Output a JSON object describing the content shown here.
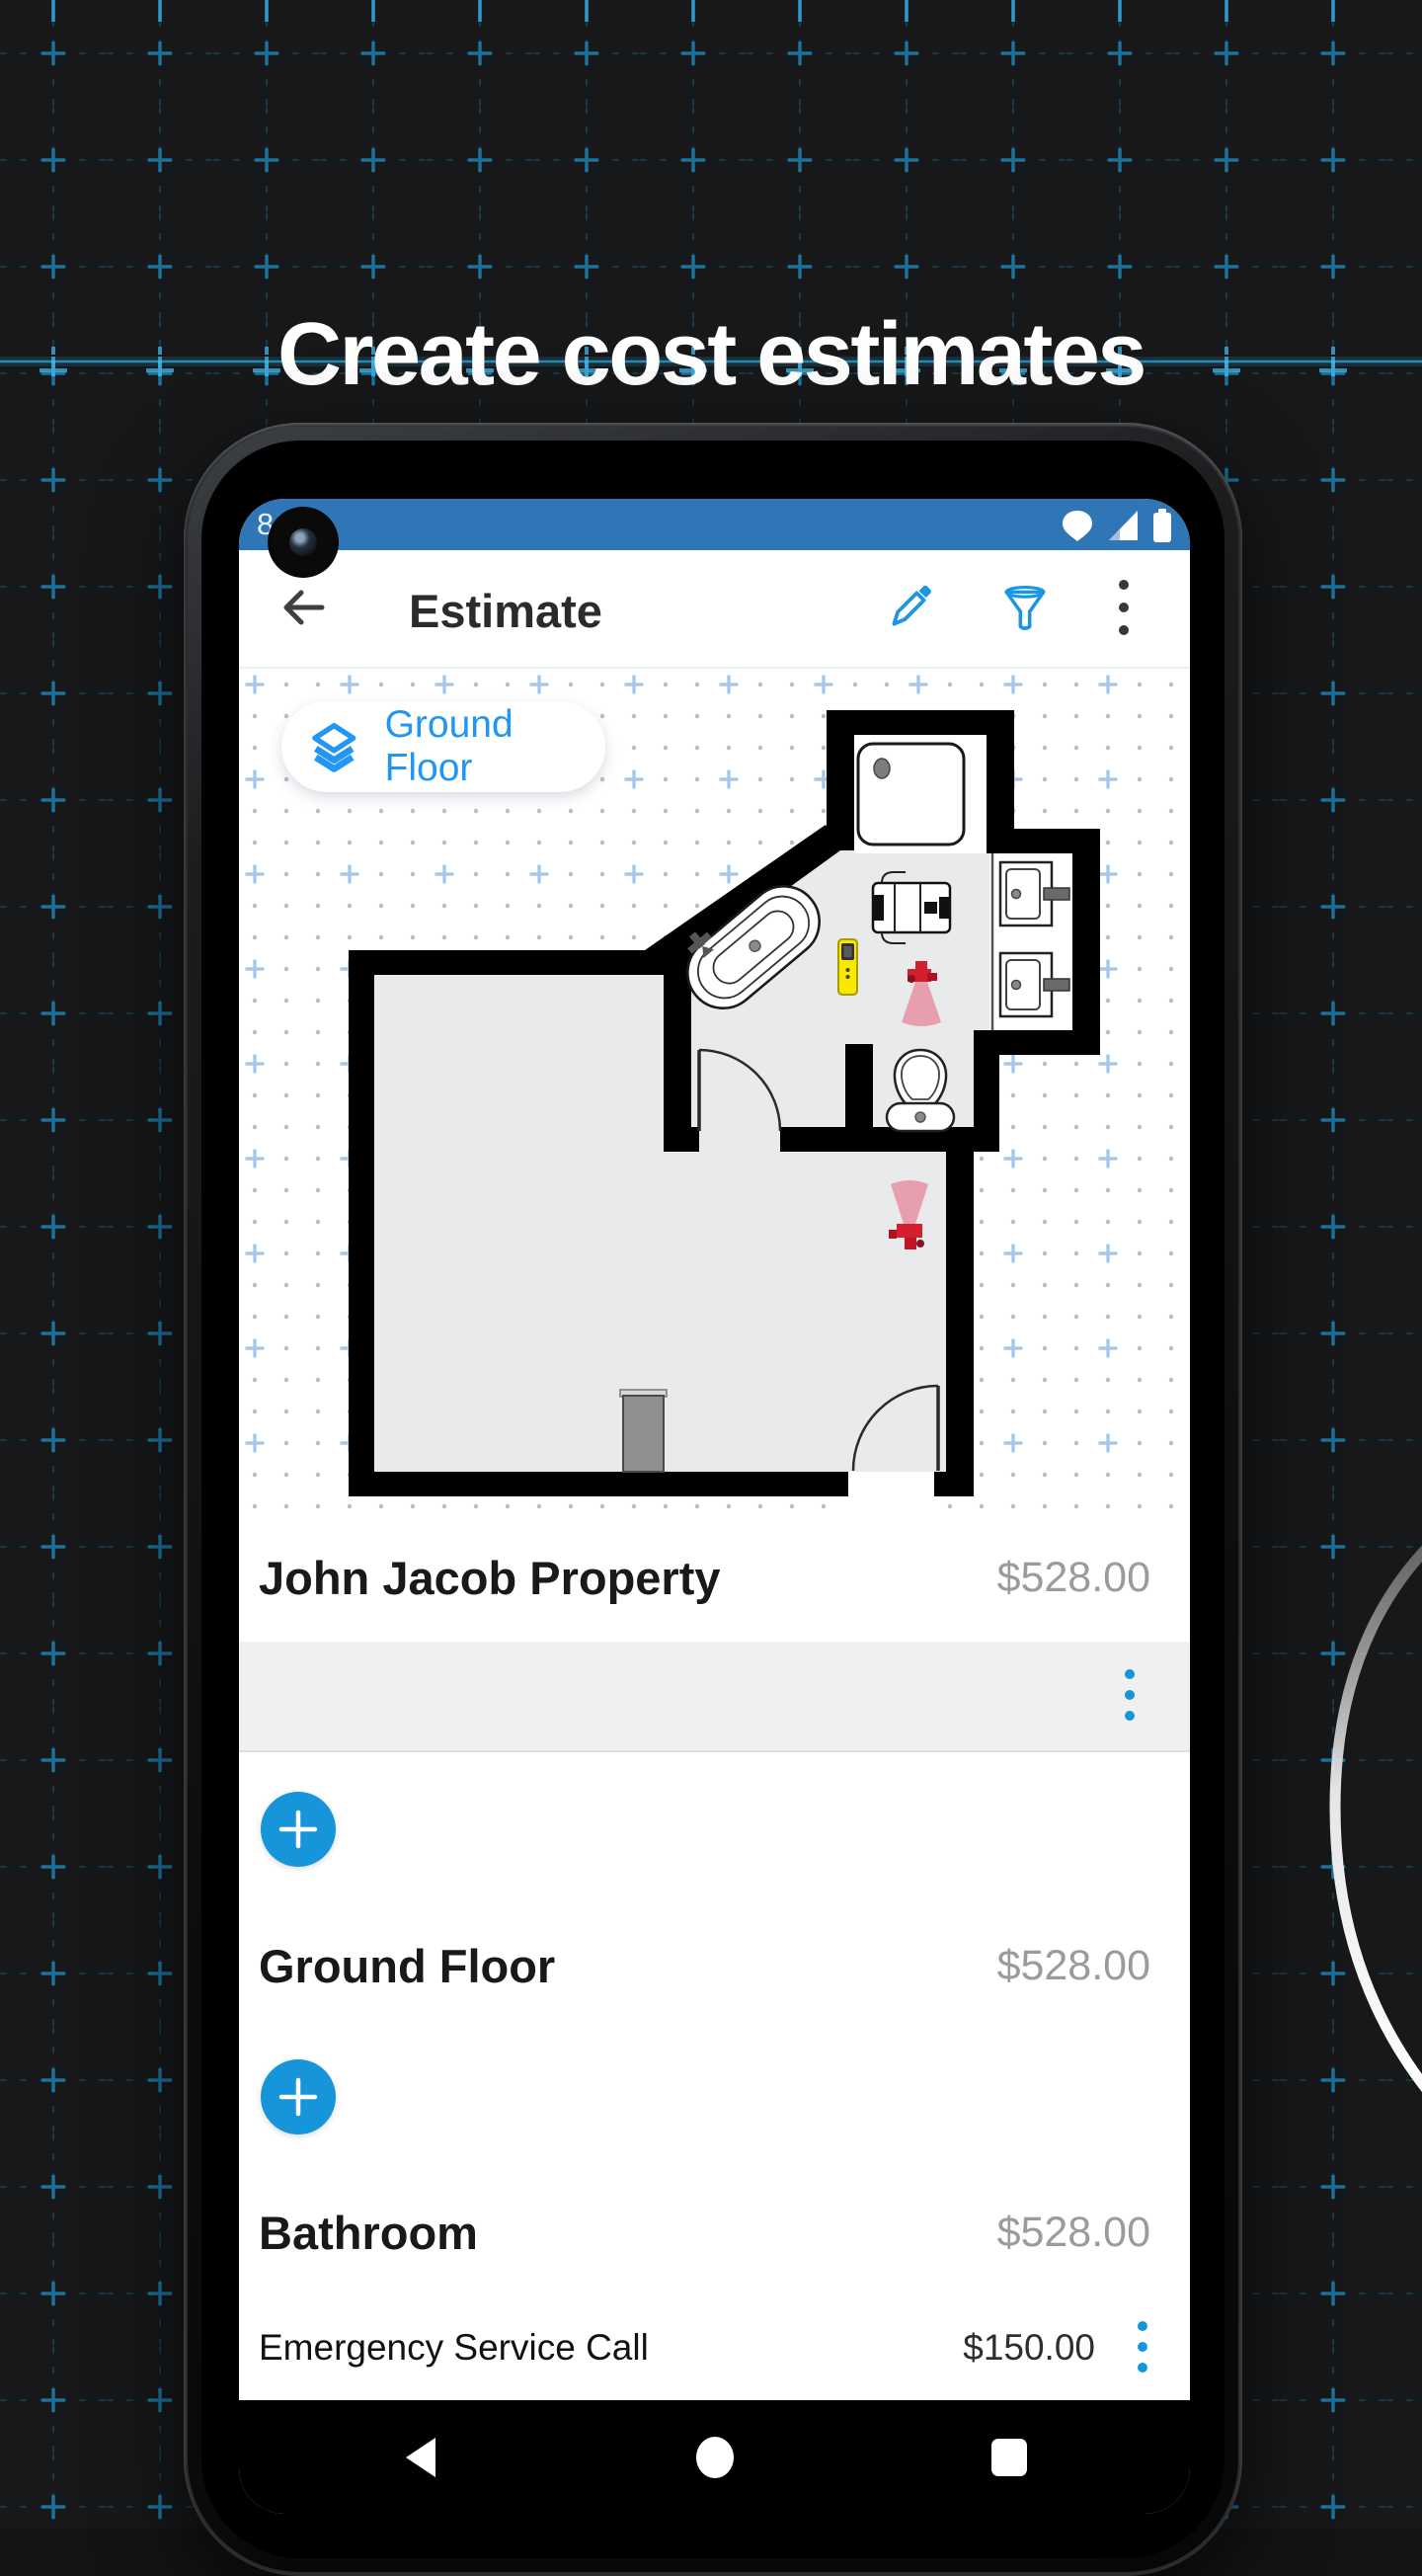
{
  "page": {
    "hero_title": "Create cost estimates"
  },
  "status_bar": {
    "time": "8:40"
  },
  "app_bar": {
    "title": "Estimate"
  },
  "floor_plan": {
    "floor_chip_label": "Ground Floor"
  },
  "rows": {
    "property": {
      "name": "John Jacob Property",
      "amount": "$528.00"
    },
    "floor": {
      "name": "Ground Floor",
      "amount": "$528.00"
    },
    "room": {
      "name": "Bathroom",
      "amount": "$528.00"
    },
    "line_item": {
      "name": "Emergency Service Call",
      "amount": "$150.00"
    }
  },
  "colors": {
    "accent_blue": "#1795da",
    "chip_blue": "#2196f3",
    "status_bar_blue": "#2e76b5",
    "price_gray": "#9b9b9b",
    "valve_red": "#d41f2f",
    "meter_yellow": "#f6e800",
    "wall_black": "#000000",
    "room_gray": "#e8eaec"
  }
}
